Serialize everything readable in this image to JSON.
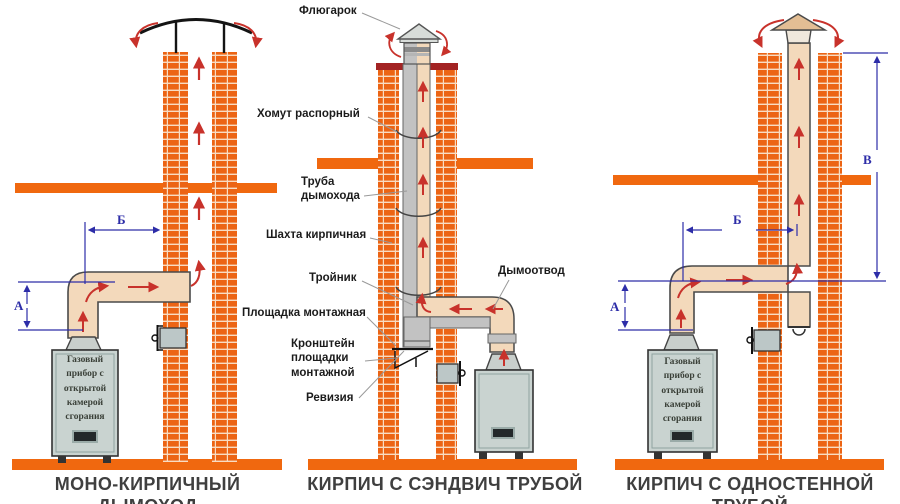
{
  "panels": {
    "left": {
      "caption": "МОНО-КИРПИЧНЫЙ ДЫМОХОД",
      "appliance_text": "Газовый\nприбор с\nоткрытой\nкамерой\nсгорания",
      "dim_a": "А",
      "dim_b": "Б"
    },
    "middle": {
      "caption": "КИРПИЧ С СЭНДВИЧ ТРУБОЙ",
      "labels": {
        "flyugarok": "Флюгарок",
        "khomut": "Хомут распорный",
        "truba": "Труба\nдымохода",
        "shakhta": "Шахта кирпичная",
        "troynik": "Тройник",
        "dymootvod": "Дымоотвод",
        "ploshchadka": "Площадка монтажная",
        "kronshteyn": "Кронштейн\nплощадки\nмонтажной",
        "reviziya": "Ревизия"
      }
    },
    "right": {
      "caption": "КИРПИЧ С ОДНОСТЕННОЙ ТРУБОЙ",
      "appliance_text": "Газовый\nприбор с\nоткрытой\nкамерой\nсгорания",
      "dim_a": "А",
      "dim_b": "Б",
      "dim_v": "В"
    }
  },
  "colors": {
    "brick": "#EC6414",
    "brick-gap": "#F8DCC2",
    "bar": "#F0680F",
    "darkred": "#A32323",
    "beige": "#F3D9BB",
    "pipe-grey": "#C2C2C2",
    "pipe-band": "#8A8A8A",
    "cap-grey": "#D8DCD9",
    "cap-tan": "#E3BE94",
    "appliance": "#C9D3D0",
    "collar": "#C9CFCC",
    "cleanout": "#BCC7C7",
    "red": "#C8322B",
    "blue": "#2D2DA8",
    "outline": "#4A4A4A",
    "pointer": "#999999",
    "ink": "#1B1B1B",
    "caption": "#3F3F3F",
    "appl-ink": "#3A4038"
  }
}
